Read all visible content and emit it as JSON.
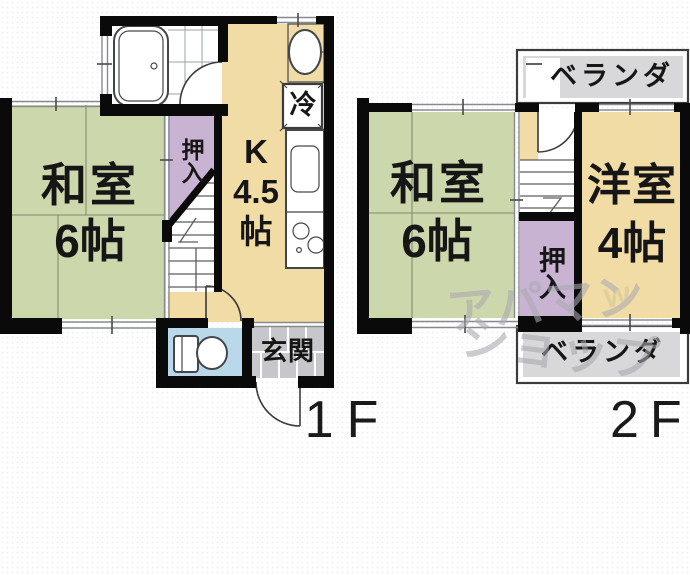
{
  "floor1": {
    "label": "1F",
    "washitsu": {
      "name": "和室",
      "size": "6帖"
    },
    "kitchen": {
      "type": "K",
      "size": "4.5",
      "unit": "帖"
    },
    "closet": "押入",
    "fridge": "冷",
    "entrance": "玄関"
  },
  "floor2": {
    "label": "2F",
    "washitsu": {
      "name": "和室",
      "size": "6帖"
    },
    "youshitsu": {
      "name": "洋室",
      "size": "4帖"
    },
    "closet": "押入",
    "veranda_top": "ベランダ",
    "veranda_bottom": "ベランダ"
  },
  "watermark": {
    "line1": "アパマン",
    "line2": "ショップ",
    "accent": "w"
  },
  "colors": {
    "tatami_green": "#cdd7ac",
    "room_yellow": "#f2dca6",
    "closet_purple": "#c9b3d3",
    "toilet_blue": "#b9d8ea",
    "entrance_gray": "#c7c7cb",
    "veranda_gray": "#d8d8da",
    "wall_black": "#0a0a0a",
    "watermark_gray": "#a9a9af"
  }
}
